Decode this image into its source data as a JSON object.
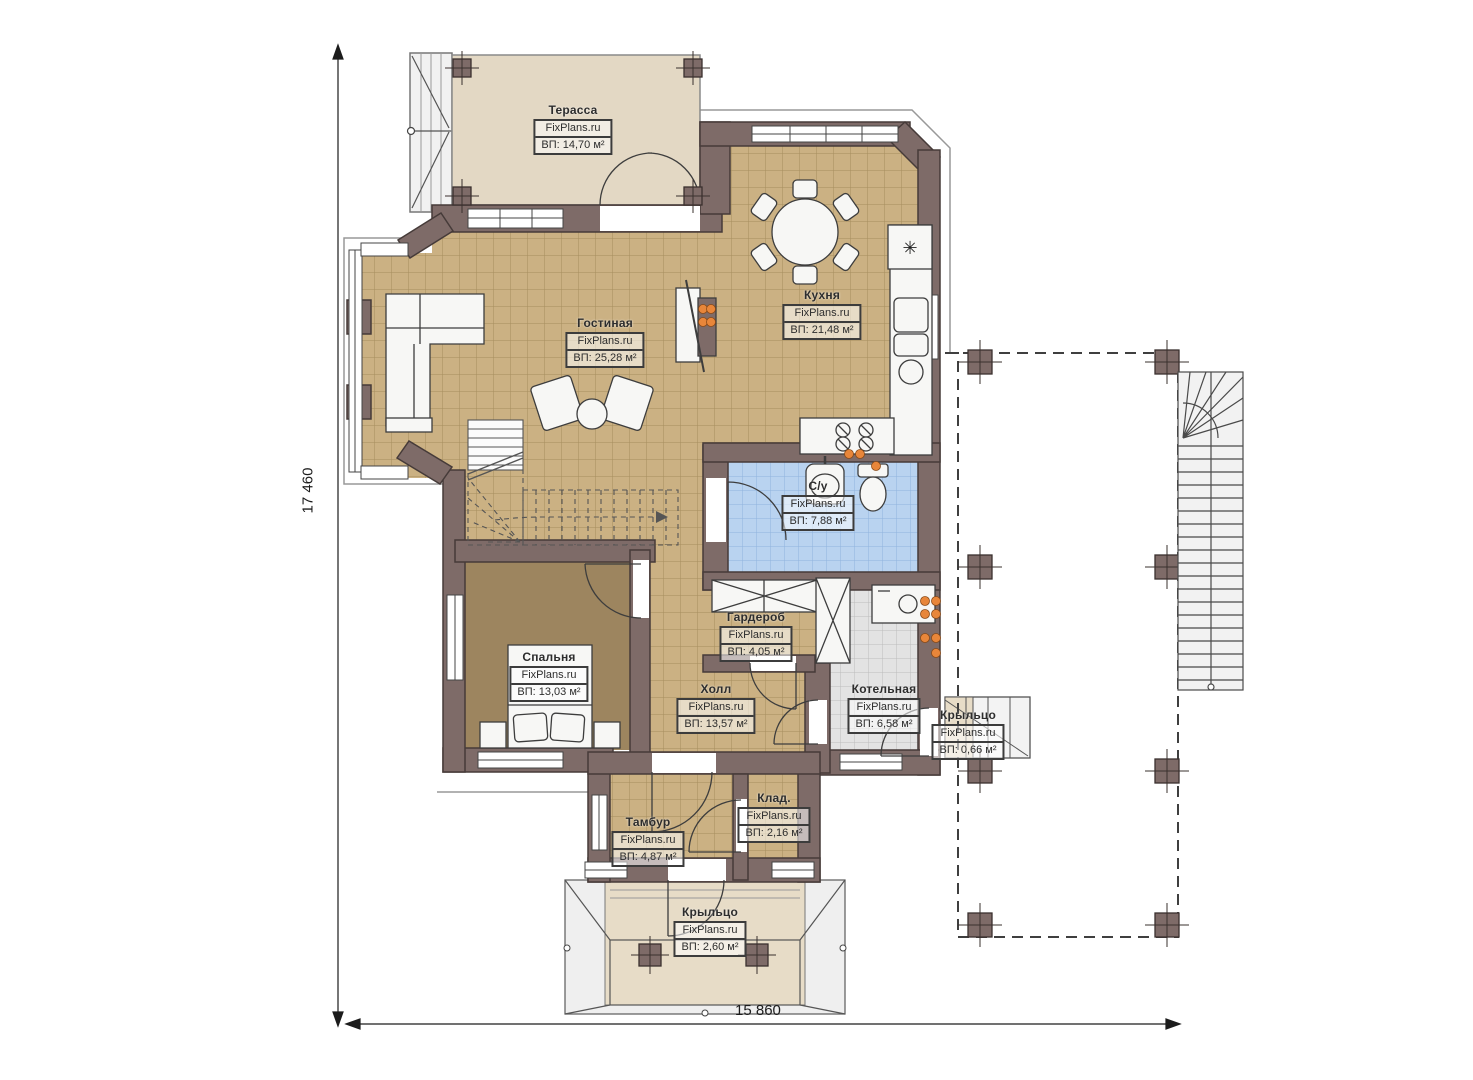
{
  "brand": "FixPlans.ru",
  "area_prefix": "ВП:",
  "dimensions": {
    "left": "17 460",
    "bottom": "15 860"
  },
  "rooms": {
    "terrace": {
      "name": "Терасса",
      "area": "ВП: 14,70 м²"
    },
    "kitchen": {
      "name": "Кухня",
      "area": "ВП: 21,48 м²"
    },
    "living": {
      "name": "Гостиная",
      "area": "ВП: 25,28 м²"
    },
    "bathroom": {
      "name": "С/у",
      "area": "ВП: 7,88 м²"
    },
    "bedroom": {
      "name": "Спальня",
      "area": "ВП: 13,03 м²"
    },
    "wardrobe": {
      "name": "Гардероб",
      "area": "ВП: 4,05 м²"
    },
    "hall": {
      "name": "Холл",
      "area": "ВП: 13,57 м²"
    },
    "boiler": {
      "name": "Котельная",
      "area": "ВП: 6,58 м²"
    },
    "porch_right": {
      "name": "Крыльцо",
      "area": "ВП: 0,66 м²"
    },
    "tambur": {
      "name": "Тамбур",
      "area": "ВП: 4,87 м²"
    },
    "storage": {
      "name": "Клад.",
      "area": "ВП: 2,16 м²"
    },
    "porch_bottom": {
      "name": "Крыльцо",
      "area": "ВП: 2,60 м²"
    }
  },
  "colors": {
    "wall": "#7e6b68",
    "tile": "#cbb183",
    "carpet": "#9d855f",
    "blue_tile": "#b9d3f0",
    "gray_tile": "#e3e3e3",
    "terrace": "#e3d8c4",
    "radiator": "#e8863a"
  }
}
